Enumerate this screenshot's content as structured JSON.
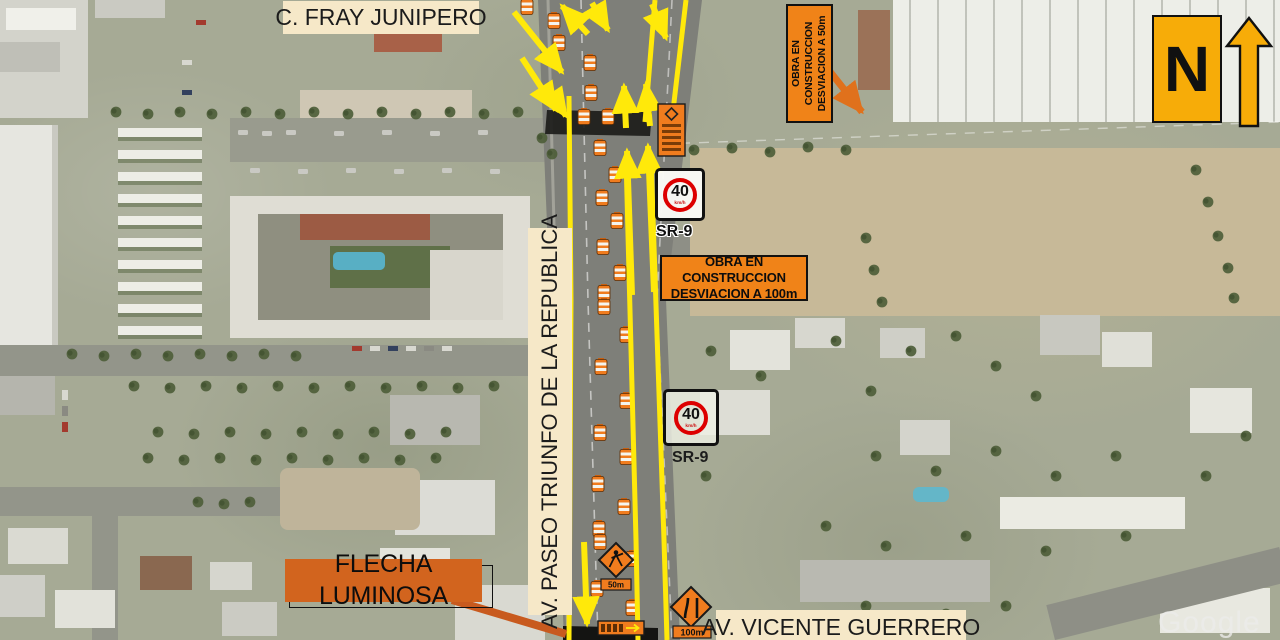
{
  "map": {
    "attribution": "Google"
  },
  "street_labels": {
    "fray_junipero": "C. FRAY JUNIPERO",
    "paseo_triunfo": "AV. PASEO TRIUNFO DE LA REPUBLICA",
    "vicente_guerrero": "AV. VICENTE GUERRERO"
  },
  "callouts": {
    "flecha_luminosa": "FLECHA LUMINOSA",
    "obra_50": {
      "line1": "OBRA EN CONSTRUCCION",
      "line2": "DESVIACION A 50m"
    },
    "obra_100": {
      "line1": "OBRA EN CONSTRUCCION",
      "line2": "DESVIACION A 100m"
    }
  },
  "signs": {
    "speed_limit_1": {
      "value": "40",
      "units": "km/h",
      "code": "SR-9"
    },
    "speed_limit_2": {
      "value": "40",
      "units": "km/h",
      "code": "SR-9"
    },
    "worker_plate": "50m",
    "narrows_plate": "100m"
  },
  "compass": {
    "north_label": "N"
  },
  "colors": {
    "construction_orange": "#F08318",
    "callout_orange": "#D2641E",
    "label_cream": "#F6E8C8",
    "lane_yellow": "#FFE90A",
    "north_yellow": "#F7AC08",
    "sign_red": "#DD0000"
  }
}
